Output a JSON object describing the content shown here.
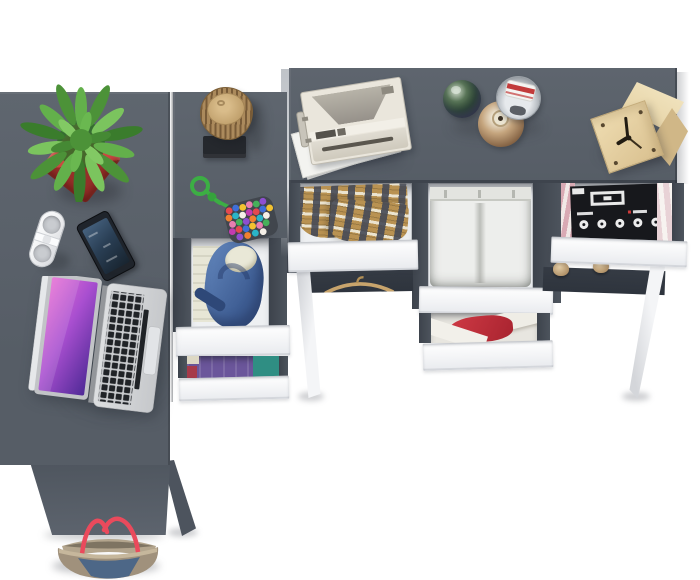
{
  "scene": {
    "title": "Top view of an anthracite grey corner desk set with open white drawers, laptop, cactus, gadgets and clothes",
    "background": "#ffffff"
  },
  "palette": {
    "desk": "#565d66",
    "deskLight": "#5f666f",
    "rail": "#4d545d",
    "cavity": "#353b44",
    "interior": "#eef0f2",
    "front": "#f3f4f6",
    "leg": "#f4f5f7",
    "potRed": "#cb4840",
    "leafGreen": "#58a744",
    "bark": "#ab8a5c",
    "padBlack": "#25282d",
    "hoodie": "#3e5d93",
    "purple": "#6b569b",
    "teal": "#2f8e83",
    "wine": "#a63a4a",
    "plaid": "#b99252",
    "pants": "#edeeec",
    "redCloth": "#a8232f",
    "magBlack": "#17181c",
    "camCream": "#eae6dc",
    "wood": "#d9c08f",
    "labelRed": "#c23b3b",
    "strapRed": "#ea4a5c",
    "bagTaupe": "#a0917c",
    "bagDenim": "#4d6787",
    "screenBlue": "#2a3f55",
    "keys": "#202327"
  },
  "items": {
    "left_desk": {
      "label": "Left desk return surface"
    },
    "column": {
      "label": "Corner drawer column"
    },
    "main_desk": {
      "label": "Main desk surface"
    },
    "plant": {
      "label": "Cactus in red square pot"
    },
    "speaker": {
      "label": "White pill speaker"
    },
    "phone": {
      "label": "Smartphone with blue screen"
    },
    "laptop": {
      "label": "Open silver laptop with purple wallpaper"
    },
    "stump": {
      "label": "Decorative wood log on black tray"
    },
    "necklace": {
      "label": "Green cord toy with multicolour beads",
      "bead_colors": [
        "#e4484f",
        "#3f6fd8",
        "#f2c230",
        "#e87fb0",
        "#46b05a",
        "#8e4fd0",
        "#f08030",
        "#2ab5c8",
        "#f5f0e8",
        "#c23bb0"
      ]
    },
    "camera": {
      "label": "Vintage white camera on papers"
    },
    "perfumes": {
      "label": "Three perfume bottles"
    },
    "clock": {
      "label": "Wooden cube clock"
    },
    "drawer_backpack": {
      "label": "Open drawer with blue hoodie and cream shirts"
    },
    "drawer_purple": {
      "label": "Open drawer with purple and teal clothes"
    },
    "drawer_plaid": {
      "label": "Open drawer with plaid shirt"
    },
    "drawer_pants": {
      "label": "Open drawer with folded white trousers"
    },
    "drawer_red": {
      "label": "Open drawer with red and white clothes"
    },
    "drawer_magazines": {
      "label": "Open drawer with magazines"
    },
    "hanger": {
      "label": "Wooden hanger under desk"
    },
    "pegs": {
      "label": "Wooden knobs"
    },
    "bag": {
      "label": "Denim tote bag with red straps"
    },
    "legs": {
      "label": "White splayed desk legs"
    }
  }
}
